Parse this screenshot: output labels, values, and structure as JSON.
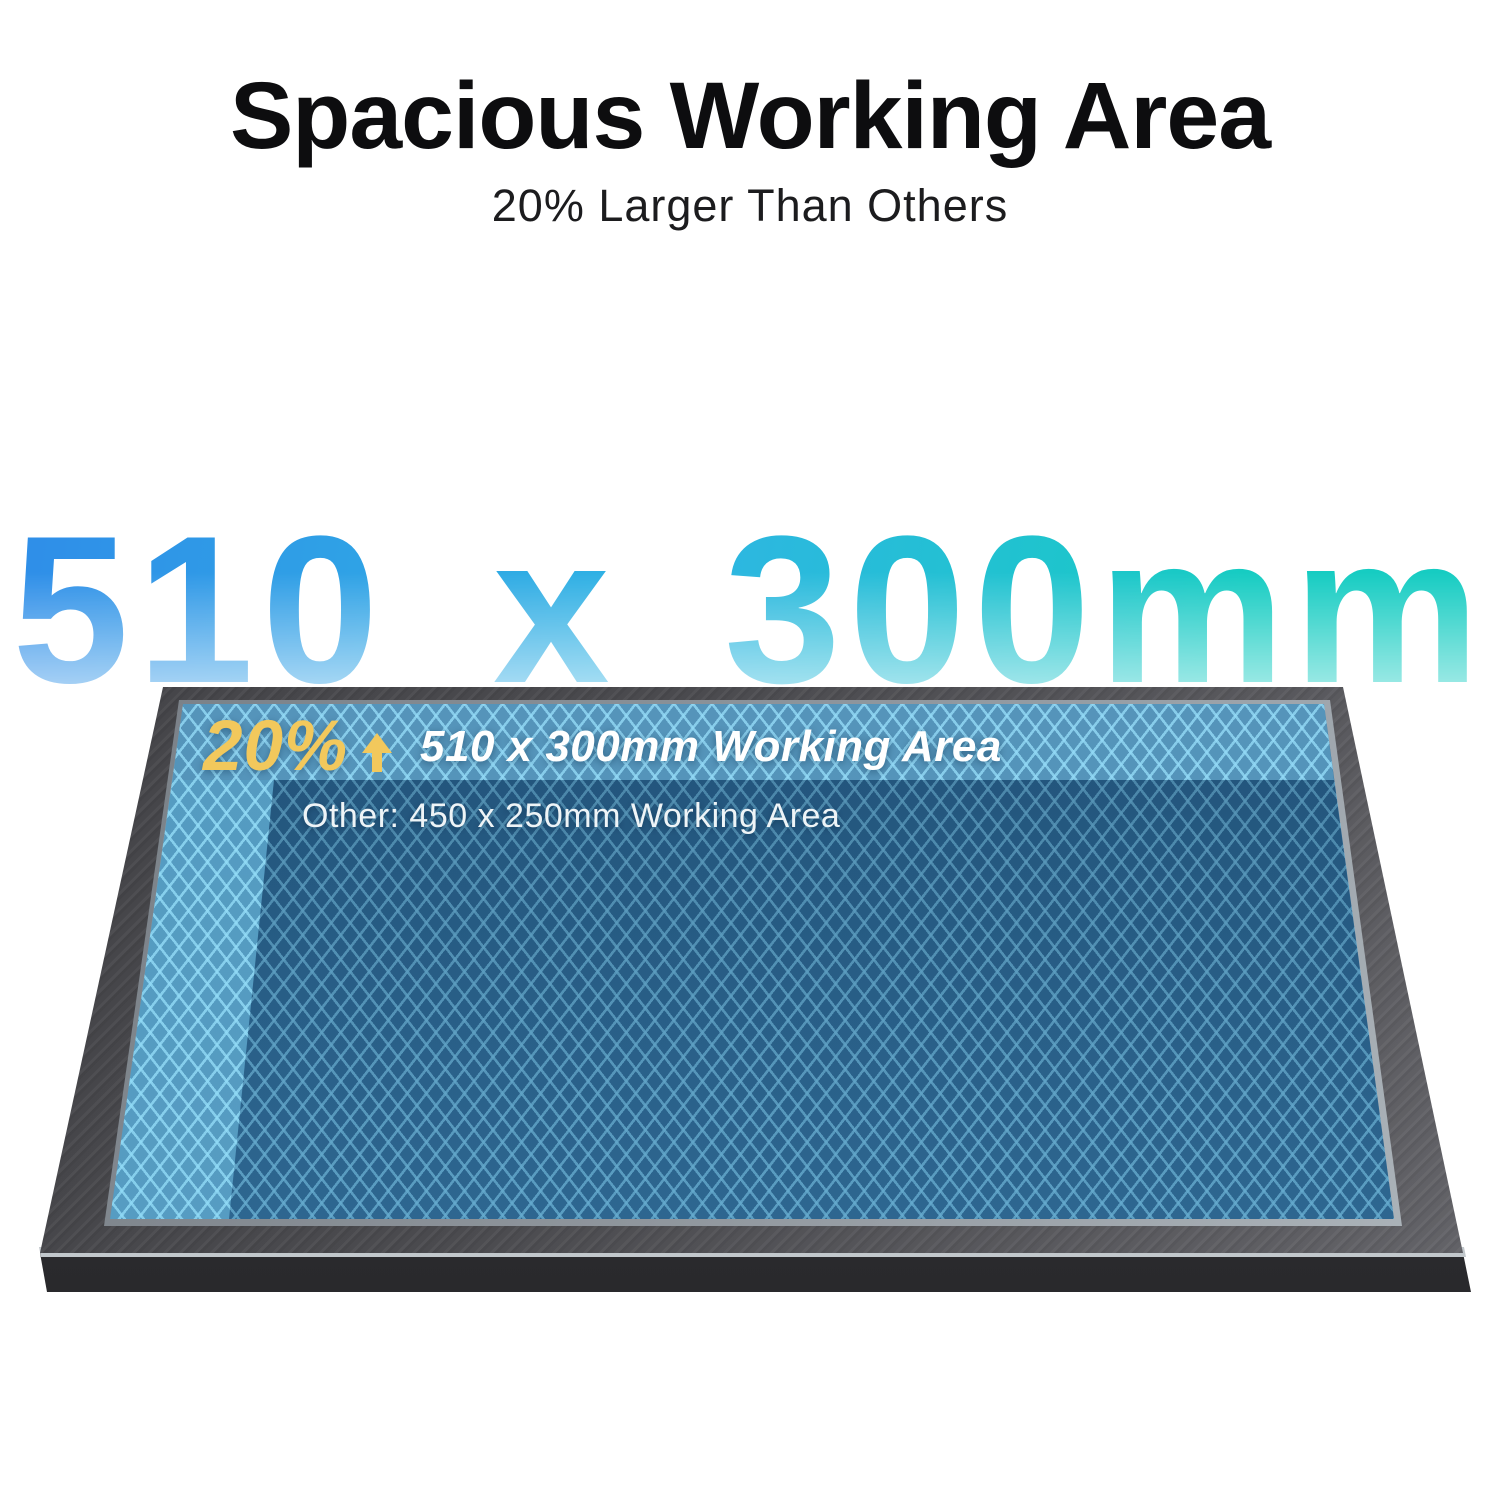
{
  "header": {
    "title": "Spacious Working Area",
    "subtitle": "20% Larger Than Others"
  },
  "hero": {
    "size_text": "510 x 300mm"
  },
  "panel": {
    "increase_percent": "20%",
    "arrow_icon": "up-arrow",
    "working_area_label": "510 x 300mm Working Area",
    "competitor_label": "Other: 450 x 250mm Working Area"
  },
  "colors": {
    "accent_yellow": "#F2C85C",
    "hero_gradient_start": "#2F8FE8",
    "hero_gradient_mid": "#2FB5E3",
    "hero_gradient_end": "#16CCC2",
    "honeycomb_base": "#2E72A2",
    "honeycomb_lattice": "#7DCDF2",
    "highlight_strip_blue": "#78D4FF",
    "dark_overlay_navy": "#07213C",
    "frame_gray": "#4A4A4E",
    "frame_silver": "#D9DDE1",
    "title_black": "#0D0D0F"
  }
}
